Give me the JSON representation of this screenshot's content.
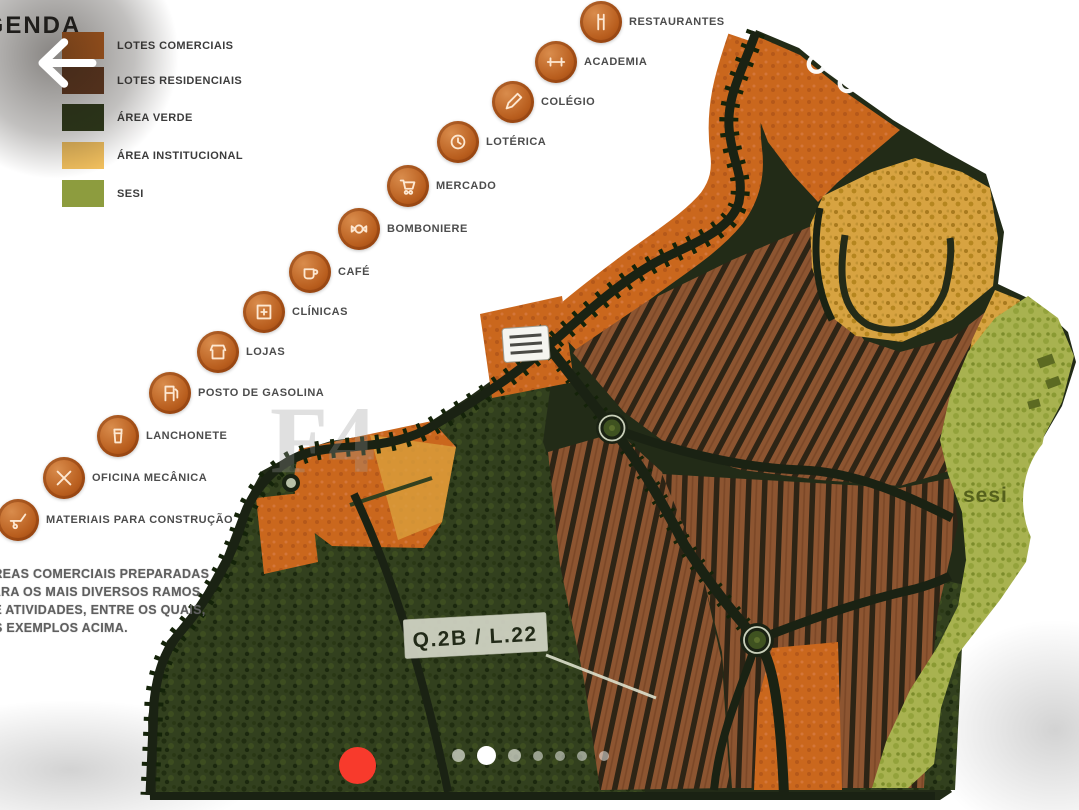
{
  "legend": {
    "title": "LEGENDA",
    "items": [
      {
        "label": "LOTES COMERCIAIS",
        "color": "#cc661c"
      },
      {
        "label": "LOTES RESIDENCIAIS",
        "color": "#6b3a1d"
      },
      {
        "label": "ÁREA VERDE",
        "color": "#2c3a17"
      },
      {
        "label": "ÁREA INSTITUCIONAL",
        "color": "#f2c05e"
      },
      {
        "label": "SESI",
        "color": "#8d9c3e"
      }
    ]
  },
  "pois": [
    {
      "label": "RESTAURANTES",
      "icon": "restaurant-icon"
    },
    {
      "label": "ACADEMIA",
      "icon": "gym-icon"
    },
    {
      "label": "COLÉGIO",
      "icon": "school-icon"
    },
    {
      "label": "LOTÉRICA",
      "icon": "lottery-icon"
    },
    {
      "label": "MERCADO",
      "icon": "market-icon"
    },
    {
      "label": "BOMBONIERE",
      "icon": "candy-shop-icon"
    },
    {
      "label": "CAFÉ",
      "icon": "cafe-icon"
    },
    {
      "label": "CLÍNICAS",
      "icon": "clinic-icon"
    },
    {
      "label": "LOJAS",
      "icon": "shops-icon"
    },
    {
      "label": "POSTO DE GASOLINA",
      "icon": "gas-station-icon"
    },
    {
      "label": "LANCHONETE",
      "icon": "snack-bar-icon"
    },
    {
      "label": "OFICINA MECÂNICA",
      "icon": "mechanic-icon"
    },
    {
      "label": "MATERIAIS PARA CONSTRUÇÃO",
      "icon": "building-materials-icon"
    }
  ],
  "map": {
    "lot_label": "Q.2B / L.22",
    "sesi_area_label": "sesi",
    "watermark": "F4",
    "notes_lines": [
      "ÁREAS COMERCIAIS PREPARADAS",
      "PARA OS MAIS DIVERSOS RAMOS",
      "DE ATIVIDADES, ENTRE OS QUAIS,",
      "OS EXEMPLOS ACIMA."
    ]
  },
  "carousel": {
    "dot_count": 7,
    "active_index": 1
  },
  "colors": {
    "commercial_orange": "#cc661c",
    "residential_brown": "#8d5531",
    "green_area": "#32401e",
    "institutional_tan": "#d7a341",
    "sesi_olive": "#a8b250",
    "road_dark": "#1a2213",
    "indicator_red": "#f83a2c",
    "ui_white": "#ffffff"
  }
}
